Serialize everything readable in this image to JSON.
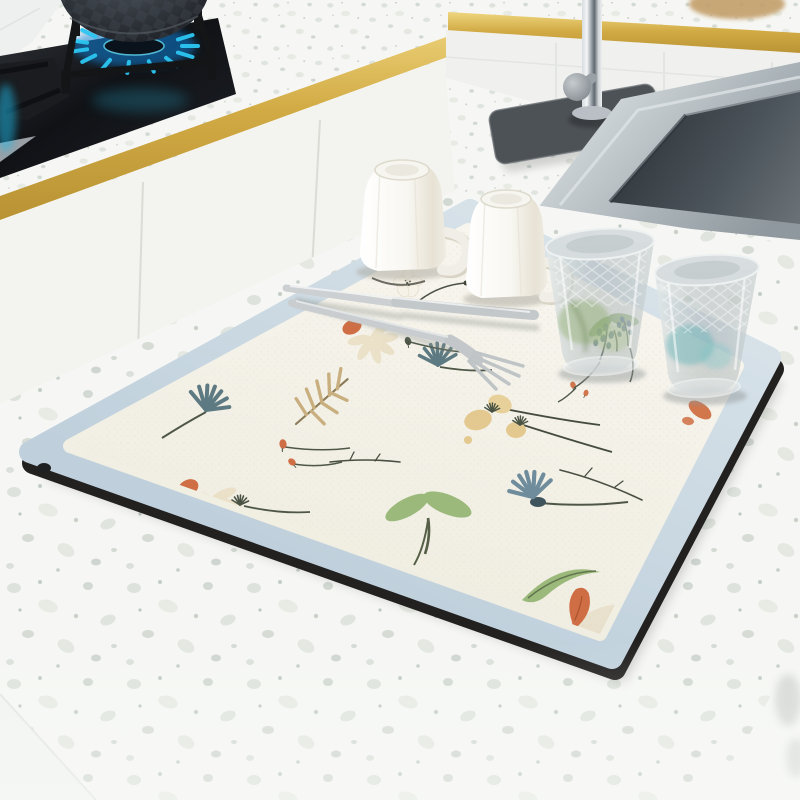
{
  "scene": {
    "type": "product-photo",
    "subject": "dish-drying-mat",
    "setting": "kitchen-countertop",
    "objects": [
      {
        "name": "gas-stove",
        "parts": [
          "wok-pan",
          "burner-grate",
          "gas-flame",
          "black-glass-cooktop",
          "side-burner"
        ]
      },
      {
        "name": "gold-trim",
        "location": "counter-edges",
        "count": 2
      },
      {
        "name": "kitchen-faucet",
        "parts": [
          "chrome-spout",
          "gray-handle",
          "round-base",
          "dark-drip-mat"
        ]
      },
      {
        "name": "stainless-sink",
        "parts": [
          "steel-rim",
          "dark-basin"
        ]
      },
      {
        "name": "drying-mat",
        "style": "watercolor-wildflowers",
        "border": "light-blue",
        "core": "cream",
        "edge": "black",
        "corners": "rounded"
      },
      {
        "name": "mug",
        "count": 2,
        "state": "upside-down",
        "color": "white",
        "detail": "faceted-with-handle"
      },
      {
        "name": "crystal-glass",
        "count": 2,
        "state": "upside-down",
        "detail": "diamond-cut"
      },
      {
        "name": "knife",
        "material": "stainless-steel"
      },
      {
        "name": "fork",
        "material": "stainless-steel"
      },
      {
        "name": "floral-motifs",
        "kinds": [
          "teal-dandelion",
          "blue-cornflower",
          "orange-buds",
          "cream-daisy",
          "wheat-frond",
          "green-leaf-pair",
          "curved-green-leaf",
          "orange-tulip",
          "teal-lavender",
          "white-dot-flower",
          "dark-twigs"
        ]
      }
    ],
    "colors": {
      "terrazzo_base": "#f6f7f4",
      "cabinet_white": "#f3f3ef",
      "tile_white": "#f0f1ee",
      "gold_trim": "#d2ab45",
      "gold_light": "#efd67f",
      "gold_dark": "#b99334",
      "cooktop_black": "#121418",
      "grate_black": "#141517",
      "flame_blue": "#2cc6f2",
      "flame_deep": "#0e7fd6",
      "pot_dark": "#23262c",
      "chrome_light": "#eef0f1",
      "chrome_mid": "#9aa2a8",
      "faucet_mat": "#4d5256",
      "sink_rim": "#b0b8be",
      "sink_basin": "#444b52",
      "mat_border": "#bfd0dc",
      "mat_border_light": "#d6e1e8",
      "mat_edge": "#232120",
      "mat_cream": "#f4f2e9",
      "flower_orange": "#cf6e44",
      "flower_teal": "#5d7a82",
      "flower_blue": "#6f8c9c",
      "leaf_green": "#9cb97c",
      "stem_dark": "#4e5747",
      "wheat_beige": "#c9af7f",
      "daisy_cream": "#e9dfc5",
      "mug_white": "#faf9f5",
      "mug_shade": "#d9d5c8",
      "glass_green": "#8fae6f",
      "glass_teal": "#62b2b6",
      "shadow_gray": "#8d9496"
    }
  }
}
